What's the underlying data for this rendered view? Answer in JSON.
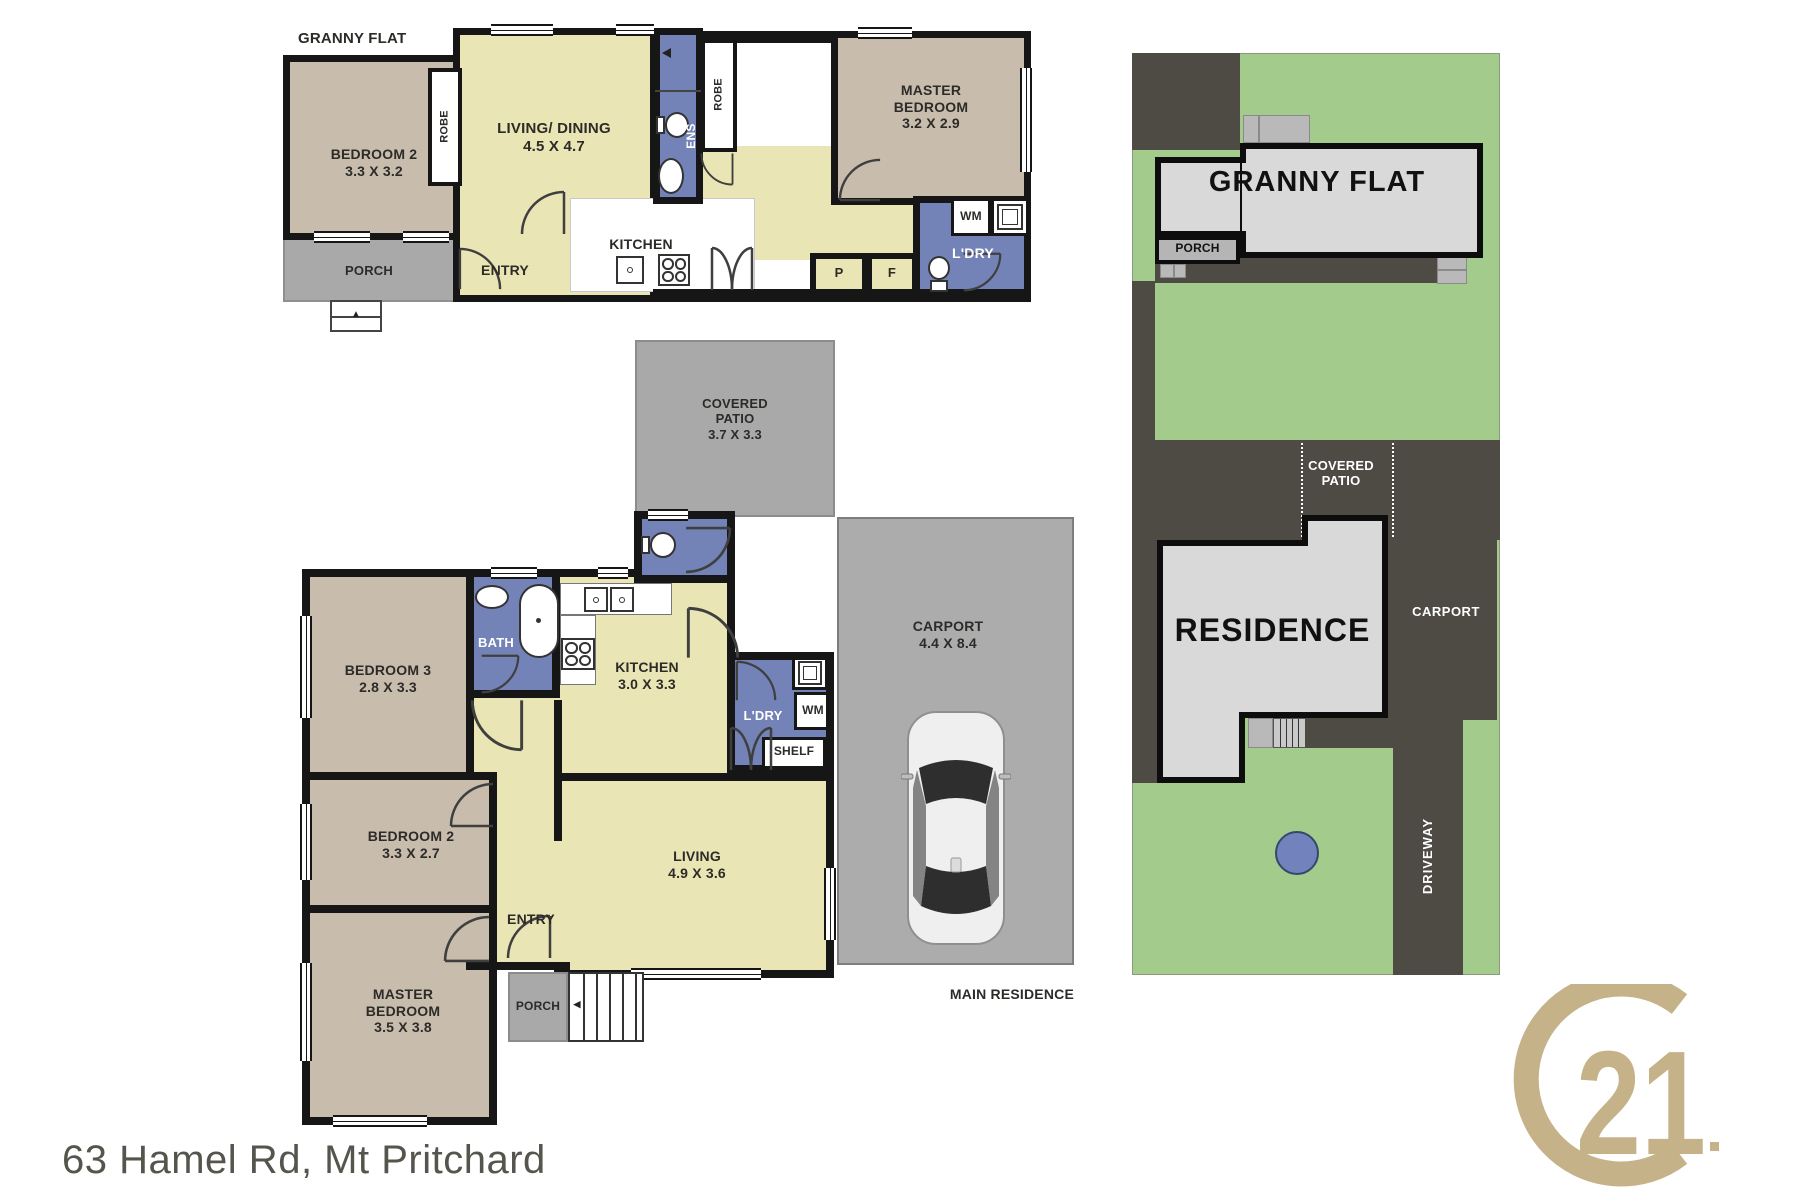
{
  "footer": {
    "address": "63 Hamel Rd, Mt Pritchard"
  },
  "logo": {
    "number": "21"
  },
  "icons": {
    "up_arrow": "▲",
    "left_arrow": "◀"
  },
  "colors": {
    "room_tan": "#c8bcad",
    "room_yellow": "#eae5b4",
    "wet_blue": "#7383b7",
    "plan_grey": "#a9a9a9",
    "carport_grey": "#acacac",
    "wall_black": "#161616",
    "site_green": "#a2cb8c",
    "site_dark": "#4d4b44",
    "site_building": "#d9d9d9",
    "gold": "#c5b288"
  },
  "granny_flat": {
    "title": "GRANNY FLAT",
    "bedroom2": {
      "lines": [
        "BEDROOM 2",
        "3.3 X 3.2"
      ]
    },
    "living": {
      "lines": [
        "LIVING/ DINING",
        "4.5 X 4.7"
      ]
    },
    "master": {
      "lines": [
        "MASTER",
        "BEDROOM",
        "3.2 X 2.9"
      ]
    },
    "kitchen": "KITCHEN",
    "entry": "ENTRY",
    "porch": "PORCH",
    "robe1": "ROBE",
    "robe2": "ROBE",
    "ens": "ENS",
    "ldry": "L'DRY",
    "wm": "WM",
    "pantry": "P",
    "fridge": "F"
  },
  "main_residence": {
    "label": "MAIN RESIDENCE",
    "covered_patio": {
      "lines": [
        "COVERED",
        "PATIO",
        "3.7 X 3.3"
      ]
    },
    "carport": {
      "lines": [
        "CARPORT",
        "4.4 X 8.4"
      ]
    },
    "bedroom3": {
      "lines": [
        "BEDROOM 3",
        "2.8 X 3.3"
      ]
    },
    "bedroom2": {
      "lines": [
        "BEDROOM 2",
        "3.3 X 2.7"
      ]
    },
    "master": {
      "lines": [
        "MASTER",
        "BEDROOM",
        "3.5 X 3.8"
      ]
    },
    "living": {
      "lines": [
        "LIVING",
        "4.9 X 3.6"
      ]
    },
    "kitchen": {
      "lines": [
        "KITCHEN",
        "3.0 X 3.3"
      ]
    },
    "bath": "BATH",
    "ldry": "L'DRY",
    "wm": "WM",
    "shelf": "SHELF",
    "entry": "ENTRY",
    "porch": "PORCH"
  },
  "site_plan": {
    "granny_flat": "GRANNY FLAT",
    "porch": "PORCH",
    "covered_patio": {
      "lines": [
        "COVERED",
        "PATIO"
      ]
    },
    "residence": "RESIDENCE",
    "carport": "CARPORT",
    "driveway": "DRIVEWAY"
  }
}
